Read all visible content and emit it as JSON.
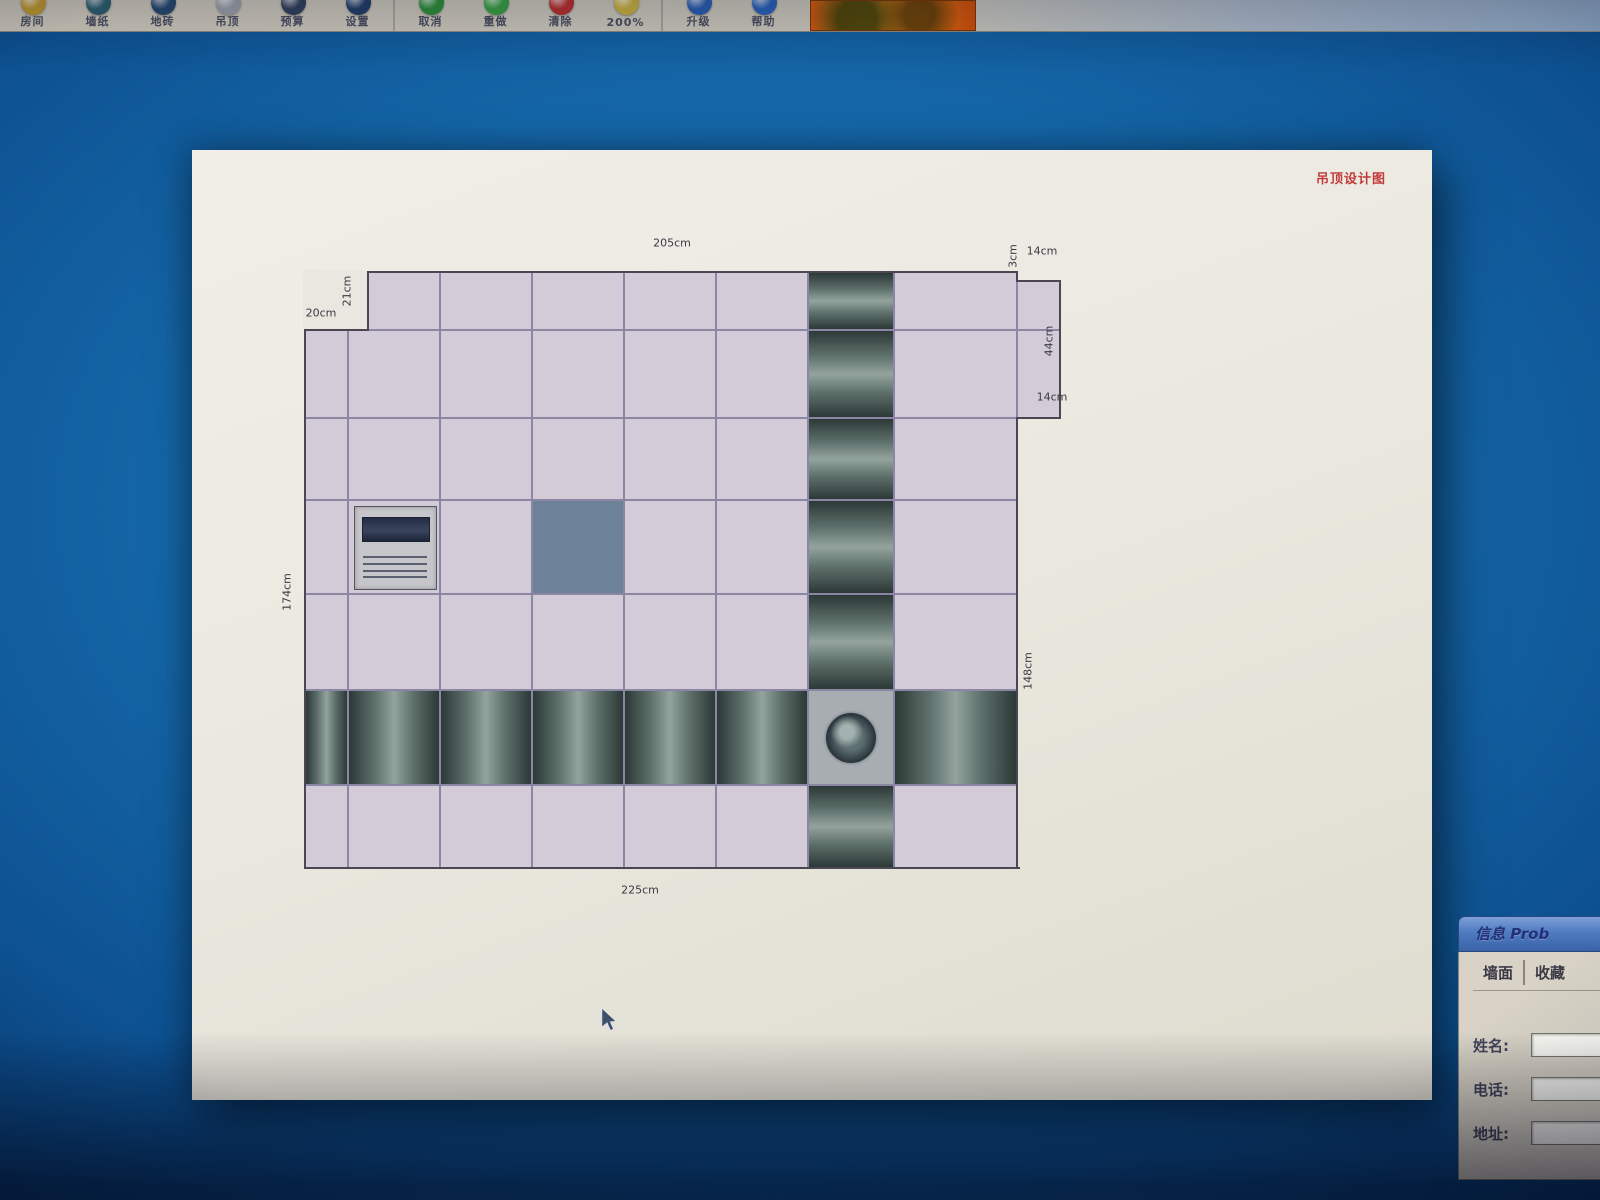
{
  "toolbar": {
    "groups": [
      {
        "items": [
          {
            "label": "房间",
            "icon": "room-icon",
            "color": "#c09a30"
          },
          {
            "label": "墙纸",
            "icon": "wallpaper-icon",
            "color": "#2f6070"
          },
          {
            "label": "地砖",
            "icon": "floor-tile-icon",
            "color": "#274a70"
          },
          {
            "label": "吊顶",
            "icon": "ceiling-icon",
            "color": "#9aa0a8"
          },
          {
            "label": "预算",
            "icon": "budget-icon",
            "color": "#31425f"
          },
          {
            "label": "设置",
            "icon": "settings-icon",
            "color": "#23406b"
          }
        ]
      },
      {
        "items": [
          {
            "label": "取消",
            "icon": "undo-icon",
            "color": "#2e8f3a"
          },
          {
            "label": "重做",
            "icon": "redo-icon",
            "color": "#37a043"
          },
          {
            "label": "清除",
            "icon": "clear-icon",
            "color": "#b83030"
          },
          {
            "label": "200%",
            "icon": "zoom-icon",
            "color": "#c8b040"
          }
        ]
      },
      {
        "items": [
          {
            "label": "升级",
            "icon": "upgrade-icon",
            "color": "#2a5fb0"
          },
          {
            "label": "帮助",
            "icon": "help-icon",
            "color": "#2a62b8"
          }
        ]
      }
    ]
  },
  "canvas": {
    "title": "吊顶设计图",
    "title_color": "#c23a3a",
    "grid": {
      "cols": [
        305,
        348,
        440,
        532,
        624,
        716,
        808,
        894,
        1017
      ],
      "rows": [
        272,
        330,
        418,
        500,
        594,
        690,
        785,
        868
      ],
      "dark_col": 6,
      "dark_row": 5,
      "ac_cell": [
        3,
        1
      ],
      "accent_cell": [
        3,
        3
      ],
      "fan_cell": [
        5,
        6
      ],
      "notch": {
        "x": 305,
        "y": 272,
        "w": 63,
        "h": 58
      },
      "bump": {
        "x": 1017,
        "y": 281,
        "w": 43,
        "bottom": 418,
        "split": 330
      },
      "outline": [
        [
          368,
          272,
          649,
          "h"
        ],
        [
          1017,
          272,
          9,
          "v"
        ],
        [
          1017,
          281,
          43,
          "h"
        ],
        [
          1060,
          281,
          137,
          "v"
        ],
        [
          1017,
          418,
          43,
          "h"
        ],
        [
          1017,
          418,
          450,
          "v"
        ],
        [
          305,
          868,
          714,
          "h"
        ],
        [
          305,
          330,
          538,
          "v"
        ],
        [
          305,
          330,
          63,
          "h"
        ],
        [
          368,
          272,
          58,
          "v"
        ]
      ],
      "colors": {
        "tile": "#d3cbd8",
        "line": "#8b86a4",
        "paper": "#e9e7df",
        "accent": "#6d8199",
        "fan_bg": "#a8adb2",
        "strip_dark": "#2c3936",
        "strip_mid": "#5d6f6a",
        "strip_light": "#93a49e"
      }
    },
    "dimension_labels": [
      {
        "text": "205cm",
        "x": 672,
        "y": 243,
        "rot": 0
      },
      {
        "text": "3cm",
        "x": 1013,
        "y": 256,
        "rot": -90
      },
      {
        "text": "14cm",
        "x": 1042,
        "y": 251,
        "rot": 0
      },
      {
        "text": "44cm",
        "x": 1049,
        "y": 341,
        "rot": -90
      },
      {
        "text": "14cm",
        "x": 1052,
        "y": 397,
        "rot": 0
      },
      {
        "text": "148cm",
        "x": 1028,
        "y": 671,
        "rot": -90
      },
      {
        "text": "174cm",
        "x": 287,
        "y": 592,
        "rot": -90
      },
      {
        "text": "20cm",
        "x": 321,
        "y": 313,
        "rot": 0
      },
      {
        "text": "21cm",
        "x": 347,
        "y": 291,
        "rot": -90
      },
      {
        "text": "225cm",
        "x": 640,
        "y": 890,
        "rot": 0
      }
    ]
  },
  "dialog": {
    "title": "信息 Prob",
    "tabs": [
      "墙面",
      "收藏"
    ],
    "fields": [
      {
        "label": "姓名:",
        "value": ""
      },
      {
        "label": "电话:",
        "value": ""
      },
      {
        "label": "地址:",
        "value": ""
      }
    ]
  }
}
